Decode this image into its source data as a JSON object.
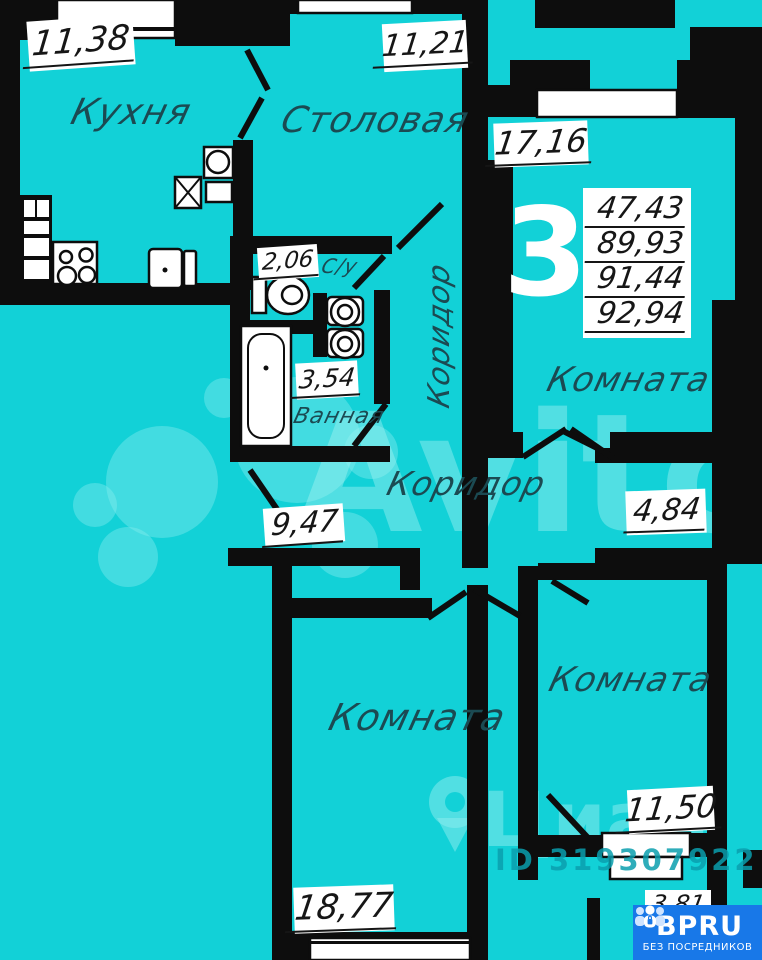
{
  "colors": {
    "background": "#12d1d7",
    "walls": "#0d0d0d",
    "number_text": "#161616",
    "room_name_text": "#1b4a52",
    "logo_background": "#1878e8"
  },
  "labels": {
    "kitchen": {
      "name": "Кухня",
      "area": "11,38"
    },
    "dining": {
      "name": "Столовая",
      "area": "11,21"
    },
    "room1": {
      "name": "Комната",
      "area": "17,16"
    },
    "wc": {
      "name": "С/у",
      "area": "2,06"
    },
    "bath": {
      "name": "Ванная",
      "area": "3,54"
    },
    "hall": {
      "area": "9,47"
    },
    "corridor_v": {
      "name": "Коридор"
    },
    "corridor_h": {
      "name": "Коридор"
    },
    "room2": {
      "name": "Комната",
      "area": "18,77"
    },
    "room3": {
      "name": "Комната",
      "area": "11,50"
    },
    "niche": {
      "area": "4,84"
    },
    "balcony": {
      "area": "3,81"
    },
    "rooms_count": "3",
    "totals": [
      "47,43",
      "89,93",
      "91,44",
      "92,94"
    ]
  },
  "watermarks": {
    "avito_text": "Avito",
    "cian_text": "Циан",
    "id_text": "ID 319307922"
  },
  "logo": {
    "brand": "BPRU",
    "tagline": "БЕЗ ПОСРЕДНИКОВ"
  }
}
